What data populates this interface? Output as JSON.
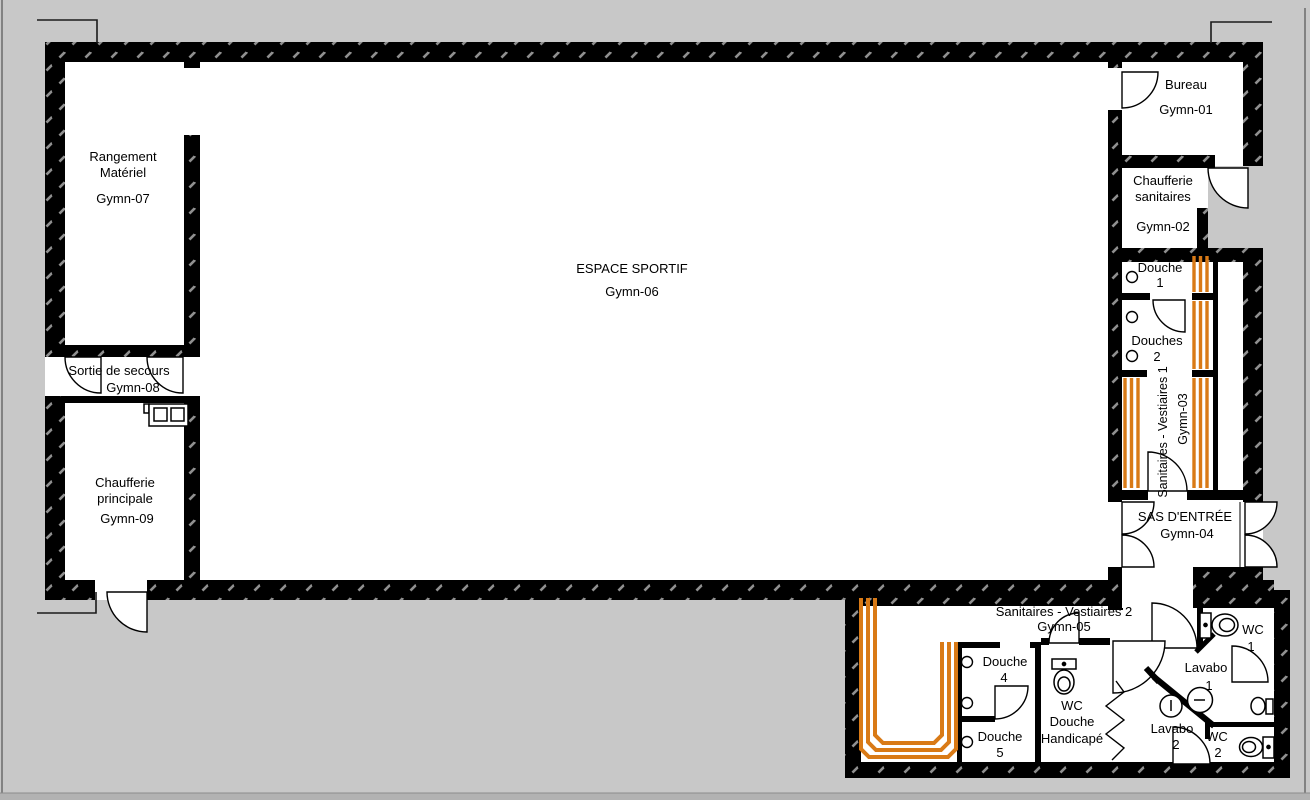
{
  "rooms": {
    "rangement": {
      "name_line1": "Rangement",
      "name_line2": "Matériel",
      "code": "Gymn-07"
    },
    "espace_sportif": {
      "name": "ESPACE SPORTIF",
      "code": "Gymn-06"
    },
    "bureau": {
      "name": "Bureau",
      "code": "Gymn-01"
    },
    "chaufferie_sanitaires": {
      "name_line1": "Chaufferie",
      "name_line2": "sanitaires",
      "code": "Gymn-02"
    },
    "vestiaires1": {
      "name": "Sanitaires - Vestiaires 1",
      "code": "Gymn-03"
    },
    "sas": {
      "name": "SAS D'ENTRÉE",
      "code": "Gymn-04"
    },
    "vestiaires2": {
      "name": "Sanitaires - Vestiaires 2",
      "code": "Gymn-05"
    },
    "sortie_secours": {
      "name": "Sortie de secours",
      "code": "Gymn-08"
    },
    "chaufferie_principale": {
      "name_line1": "Chaufferie",
      "name_line2": "principale",
      "code": "Gymn-09"
    }
  },
  "fixtures": {
    "douche1": {
      "label": "Douche",
      "num": "1"
    },
    "douches2": {
      "label": "Douches",
      "num": "2"
    },
    "douche4": {
      "label": "Douche",
      "num": "4"
    },
    "douche5": {
      "label": "Douche",
      "num": "5"
    },
    "wc_handicape": {
      "line1": "WC",
      "line2": "Douche",
      "line3": "Handicapé"
    },
    "lavabo1": {
      "label": "Lavabo",
      "num": "1"
    },
    "lavabo2": {
      "label": "Lavabo",
      "num": "2"
    },
    "wc1": {
      "label": "WC",
      "num": "1"
    },
    "wc2": {
      "label": "WC",
      "num": "2"
    }
  },
  "colors": {
    "background": "#c8c8c8",
    "room_fill": "#ffffff",
    "wall": "#000000",
    "wall_hatch": "#8f8f8f",
    "bench_orange": "#d97a16",
    "bottom_edge": "#b2b2b2"
  }
}
